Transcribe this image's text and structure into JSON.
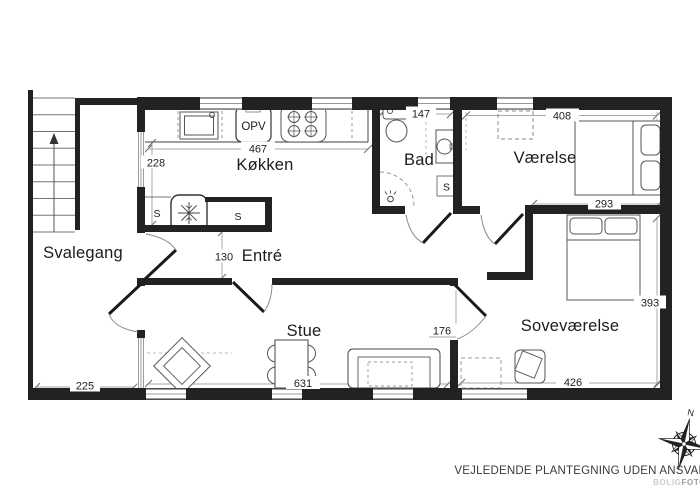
{
  "plan": {
    "rooms": {
      "svalegang": "Svalegang",
      "kokken": "Køkken",
      "entre": "Entré",
      "bad": "Bad",
      "vaerelse": "Værelse",
      "sovevaerelse": "Soveværelse",
      "stue": "Stue"
    },
    "dimensions_cm": {
      "kokken_width": "467",
      "kokken_depth": "228",
      "entre_opening": "130",
      "bad_width": "147",
      "vaerelse_width": "408",
      "vaerelse_inner_width": "293",
      "sovevaerelse_depth": "393",
      "sovevaerelse_width": "426",
      "sovevaerelse_passage": "176",
      "stue_width": "631",
      "svalegang_width": "225"
    },
    "symbols": {
      "closet": "S",
      "dishwasher": "OPV",
      "compass_north": "N"
    },
    "footer": {
      "disclaimer": "VEJLEDENDE PLANTEGNING UDEN ANSVAR",
      "brand_light": "BOLIG",
      "brand_bold": "FOTO"
    },
    "colors": {
      "wall": "#222222",
      "thin_line": "#5a5a5a",
      "dim_line": "#aaaaaa",
      "text": "#1c1c1c"
    }
  }
}
